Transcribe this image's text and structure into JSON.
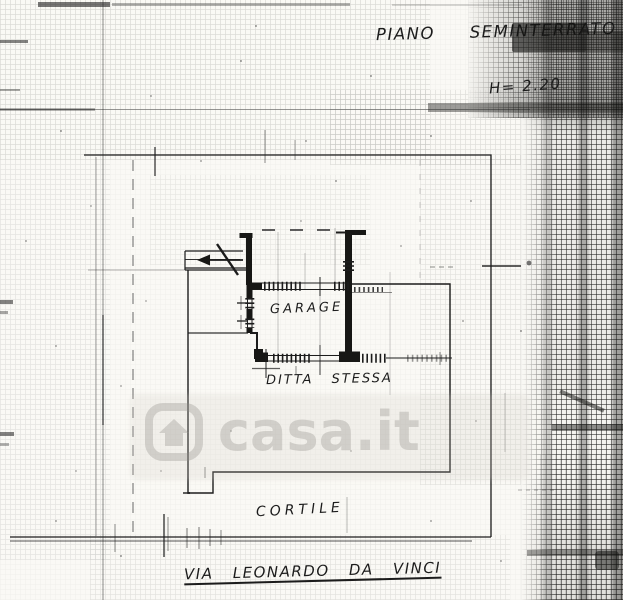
{
  "plan": {
    "floor_title": "PIANO SEMINTERRATO",
    "height_note": "H= 2.20",
    "labels": {
      "garage": "GARAGE",
      "ditta": "DITTA STESSA",
      "cortile": "CORTILE",
      "street": "VIA LEONARDO DA VINCI"
    }
  },
  "watermark": {
    "text": "casa.it",
    "icon": "house-icon"
  },
  "colors": {
    "ink": "#1c1c1c",
    "paper": "#faf9f5",
    "watermark_gray": "rgba(146,144,136,0.33)"
  }
}
